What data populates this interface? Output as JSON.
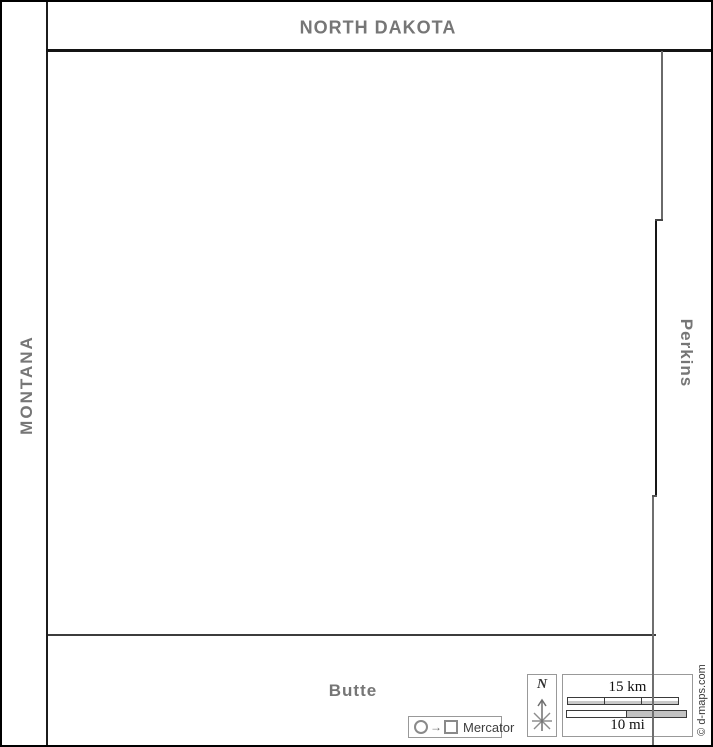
{
  "labels": {
    "north_dakota": "NORTH DAKOTA",
    "montana": "MONTANA",
    "perkins": "Perkins",
    "butte": "Butte"
  },
  "compass": {
    "north": "N"
  },
  "scale_bar": {
    "km": "15 km",
    "mi": "10 mi"
  },
  "projection": {
    "name": "Mercator",
    "symbol_arrow": "→"
  },
  "credit": {
    "text": "© d-maps.com"
  },
  "colors": {
    "label_gray": "#767676",
    "state_line": "#1c1c1c",
    "county_line_dark": "#161616",
    "county_line_gray": "#6f6f6f",
    "box_border": "#999999",
    "bar_gray_fill": "#c2c2c2"
  }
}
